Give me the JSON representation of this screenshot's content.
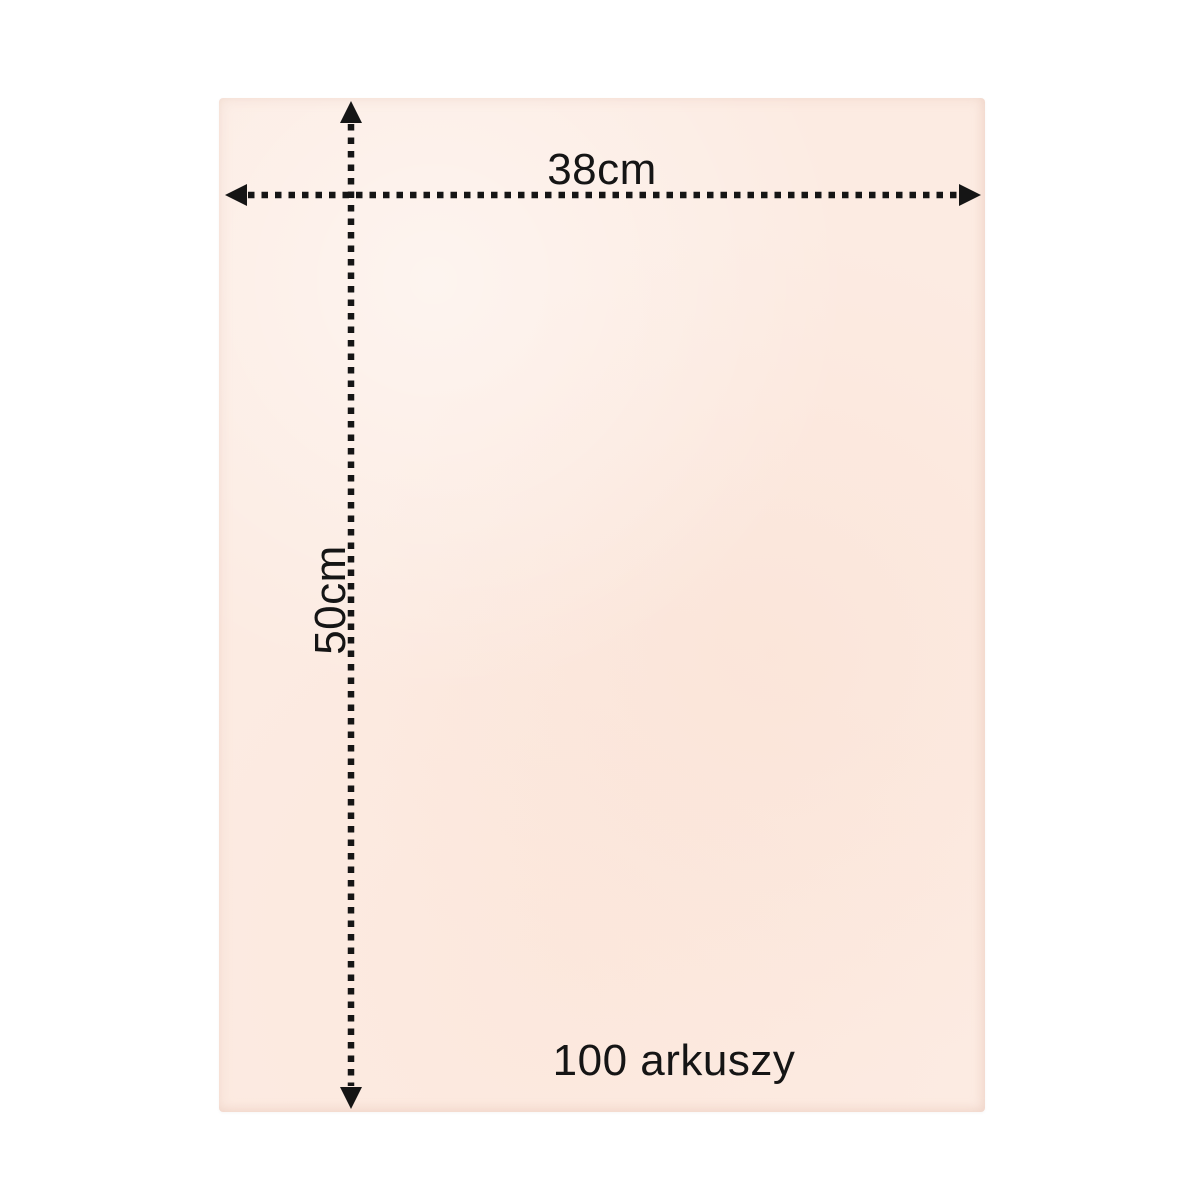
{
  "product_sheet": {
    "width_label": "38cm",
    "height_label": "50cm",
    "quantity_label": "100 arkuszy"
  },
  "icons": {
    "arrow_left": "solid-triangle-left",
    "arrow_right": "solid-triangle-right",
    "arrow_up": "solid-triangle-up",
    "arrow_down": "solid-triangle-down",
    "line_style": "square-dotted"
  },
  "colors": {
    "background": "#ffffff",
    "paper": "#fcebe2",
    "annotation": "#151515"
  }
}
